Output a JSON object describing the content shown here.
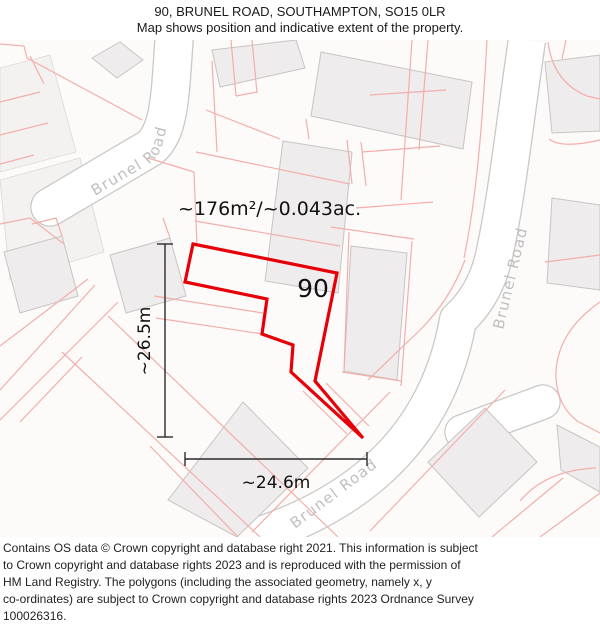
{
  "header": {
    "title": "90, BRUNEL ROAD, SOUTHAMPTON, SO15 0LR",
    "subtitle": "Map shows position and indicative extent of the property."
  },
  "footer": {
    "lines": [
      "Contains OS data © Crown copyright and database right 2021. This information is subject",
      "to Crown copyright and database rights 2023 and is reproduced with the permission of",
      "HM Land Registry. The polygons (including the associated geometry, namely x, y",
      "co-ordinates) are subject to Crown copyright and database rights 2023 Ordnance Survey",
      "100026316."
    ]
  },
  "map": {
    "labels": {
      "area": "~176m²/~0.043ac.",
      "plot_number": "90",
      "dim_vertical": "~26.5m",
      "dim_horizontal": "~24.6m",
      "road": "Brunel Road"
    },
    "colors": {
      "map_bg": "#fcfbfa",
      "road_fill": "#ffffff",
      "road_edge": "#cbc9c7",
      "building_fill": "#eeecec",
      "building_edge": "#c8c5c2",
      "tint_fill": "#f4f2f0",
      "tint_edge": "#dbd8d5",
      "parcel": "#f3aeaa",
      "property_outline": "#e60008",
      "dimension": "#2b2b2b",
      "label_text": "#111111",
      "road_label": "#c0bfbf"
    },
    "property_outline_path": "M 193,244 L 337,273 L 315,381 L 363,438 L 291,372 L 293,345 L 262,334 L 267,299 L 185,282 Z",
    "roads": [
      {
        "name": "brunel-road-west",
        "d": "M 174,40 C 170,100 169,132 150,148 L 50,207",
        "w": 37,
        "cap": "round"
      },
      {
        "name": "brunel-road-east",
        "d": "M 527,40 C 514,128 506,204 493,260 Q 484,296 458,320 Q 430,480 255,537",
        "w": 36,
        "cap": "butt"
      },
      {
        "name": "road-stub",
        "d": "M 462,432 L 543,402",
        "w": 33,
        "cap": "round"
      }
    ],
    "tints": [
      {
        "d": "M 0,68 L 50,55 L 76,152 L 0,172 Z"
      },
      {
        "d": "M 0,180 L 80,158 L 104,252 L 10,280 Z"
      }
    ],
    "buildings": [
      {
        "d": "M 92,58 L 120,42 L 143,60 L 117,78 Z"
      },
      {
        "d": "M 212,50 L 296,40 L 305,68 L 220,87 Z"
      },
      {
        "d": "M 321,52 L 472,82 L 463,149 L 311,116 Z"
      },
      {
        "d": "M 283,141 L 352,152 L 338,293 L 265,281 Z"
      },
      {
        "d": "M 351,246 L 407,253 L 397,380 L 344,371 Z"
      },
      {
        "d": "M 552,198 L 600,205 L 600,290 L 547,283 Z"
      },
      {
        "d": "M 545,62 L 600,55 L 600,131 L 552,133 Z"
      },
      {
        "d": "M 110,255 L 170,238 L 186,296 L 126,313 Z"
      },
      {
        "d": "M 4,252 L 62,236 L 78,296 L 20,313 Z"
      },
      {
        "d": "M 243,402 L 308,468 L 237,537 L 168,500 Z"
      },
      {
        "d": "M 485,408 L 537,462 L 479,517 L 428,462 Z"
      },
      {
        "d": "M 557,425 L 600,447 L 600,492 L 561,470 Z"
      }
    ],
    "parcel_lines": [
      {
        "d": "M 0,44 L 24,46 L 27,58 L 142,120"
      },
      {
        "d": "M 30,56 L 44,84"
      },
      {
        "d": "M 0,102 L 40,92"
      },
      {
        "d": "M 0,135 L 48,123"
      },
      {
        "d": "M 0,164 L 34,155"
      },
      {
        "d": "M 0,224 L 30,218 L 64,244"
      },
      {
        "d": "M 231,40 L 236,96"
      },
      {
        "d": "M 252,40 L 257,93"
      },
      {
        "d": "M 236,96 L 257,92"
      },
      {
        "d": "M 212,61 L 217,152"
      },
      {
        "d": "M 206,110 L 280,139"
      },
      {
        "d": "M 196,152 L 350,184"
      },
      {
        "d": "M 195,221 L 340,246"
      },
      {
        "d": "M 347,140 L 352,184"
      },
      {
        "d": "M 361,142 L 366,186"
      },
      {
        "d": "M 306,119 L 309,139"
      },
      {
        "d": "M 331,227 L 414,239"
      },
      {
        "d": "M 349,232 L 344,371"
      },
      {
        "d": "M 412,241 L 401,386"
      },
      {
        "d": "M 342,372 L 401,381"
      },
      {
        "d": "M 326,383 L 369,426"
      },
      {
        "d": "M 303,391 L 347,434"
      },
      {
        "d": "M 154,296 L 263,313"
      },
      {
        "d": "M 156,318 L 263,334"
      },
      {
        "d": "M 148,158 L 194,172"
      },
      {
        "d": "M 194,172 L 197,245"
      },
      {
        "d": "M 487,40 C 482,130 476,200 464,258"
      },
      {
        "d": "M 465,260 Q 450,300 420,330 L 368,380"
      },
      {
        "d": "M 412,40 L 401,200"
      },
      {
        "d": "M 428,40 L 419,150"
      },
      {
        "d": "M 370,95 L 446,90"
      },
      {
        "d": "M 362,152 L 440,146"
      },
      {
        "d": "M 356,208 L 433,202"
      },
      {
        "d": "M 548,42 Q 553,82 587,96 L 600,99"
      },
      {
        "d": "M 566,40 L 562,59"
      },
      {
        "d": "M 600,140 Q 562,149 549,139"
      },
      {
        "d": "M 600,302 Q 558,331 556,372 Q 555,403 577,421 L 600,433"
      },
      {
        "d": "M 505,390 L 370,531"
      },
      {
        "d": "M 492,537 L 563,478"
      },
      {
        "d": "M 540,537 L 600,493"
      },
      {
        "d": "M 520,501 Q 546,470 596,468"
      },
      {
        "d": "M 545,262 L 600,255"
      },
      {
        "d": "M 88,279 L 0,346"
      },
      {
        "d": "M 118,302 L 0,420"
      },
      {
        "d": "M 108,316 L 338,537"
      },
      {
        "d": "M 62,352 L 260,537"
      },
      {
        "d": "M 150,446 L 238,537"
      },
      {
        "d": "M 390,392 L 252,532"
      },
      {
        "d": "M 62,236 L 56,218 L 32,224"
      },
      {
        "d": "M 170,238 L 163,218"
      },
      {
        "d": "M 0,390 L 95,285"
      },
      {
        "d": "M 20,422 L 82,357"
      }
    ],
    "road_label_paths": [
      {
        "id": "rlp-west",
        "d": "M 95,196 L 146,166 Q 158,159 162,146 L 186,52"
      },
      {
        "id": "rlp-east",
        "d": "M 503,330 L 538,184"
      },
      {
        "id": "rlp-south",
        "d": "M 295,529 L 421,434"
      }
    ],
    "dimensions": {
      "vertical": {
        "line": "M 165,244 L 165,437",
        "ticks": [
          "M 157,244 L 173,244",
          "M 157,437 L 173,437"
        ],
        "label_x": 150,
        "label_y": 341
      },
      "horizontal": {
        "line": "M 185,459 L 367,459",
        "ticks": [
          "M 185,452 L 185,466",
          "M 367,452 L 367,466"
        ],
        "label_x": 276,
        "label_y": 488
      }
    },
    "text_positions": {
      "area": {
        "x": 178,
        "y": 215,
        "size": 19
      },
      "plot_number": {
        "x": 313,
        "y": 297,
        "size": 25
      }
    }
  }
}
